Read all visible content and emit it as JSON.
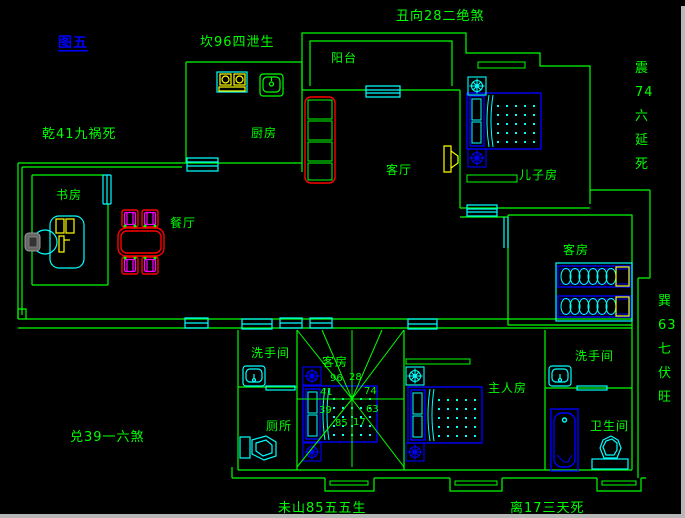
{
  "figure_label": "图五",
  "fengshui": {
    "kan": "坎96四泄生",
    "chou": "丑向28二绝煞",
    "qian": "乾41九祸死",
    "dui": "兑39一六煞",
    "wei": "未山85五五生",
    "li": "离17三天死",
    "zhen": [
      "震",
      "74",
      "六",
      "延",
      "死"
    ],
    "xun": [
      "巽",
      "63",
      "七",
      "伏",
      "旺"
    ]
  },
  "rooms": {
    "balcony": "阳台",
    "kitchen": "厨房",
    "living": "客厅",
    "study": "书房",
    "dining": "餐厅",
    "son": "儿子房",
    "guest_east": "客房",
    "guest_center": "客房",
    "washroom_west": "洗手间",
    "toilet": "厕所",
    "master": "主人房",
    "washroom_east": "洗手间",
    "bathroom": "卫生间"
  },
  "compass": {
    "numbers": [
      "96",
      "28",
      "41",
      "74",
      "39",
      "63",
      "85",
      "17"
    ]
  },
  "colors": {
    "background": "#000000",
    "wall": "#00ff00",
    "fixture": "#00ffff",
    "furniture": "#0000ff",
    "accent_yellow": "#ffff00",
    "accent_red": "#ff0000",
    "accent_magenta": "#ff00ff",
    "figure_link": "#0000ff"
  }
}
